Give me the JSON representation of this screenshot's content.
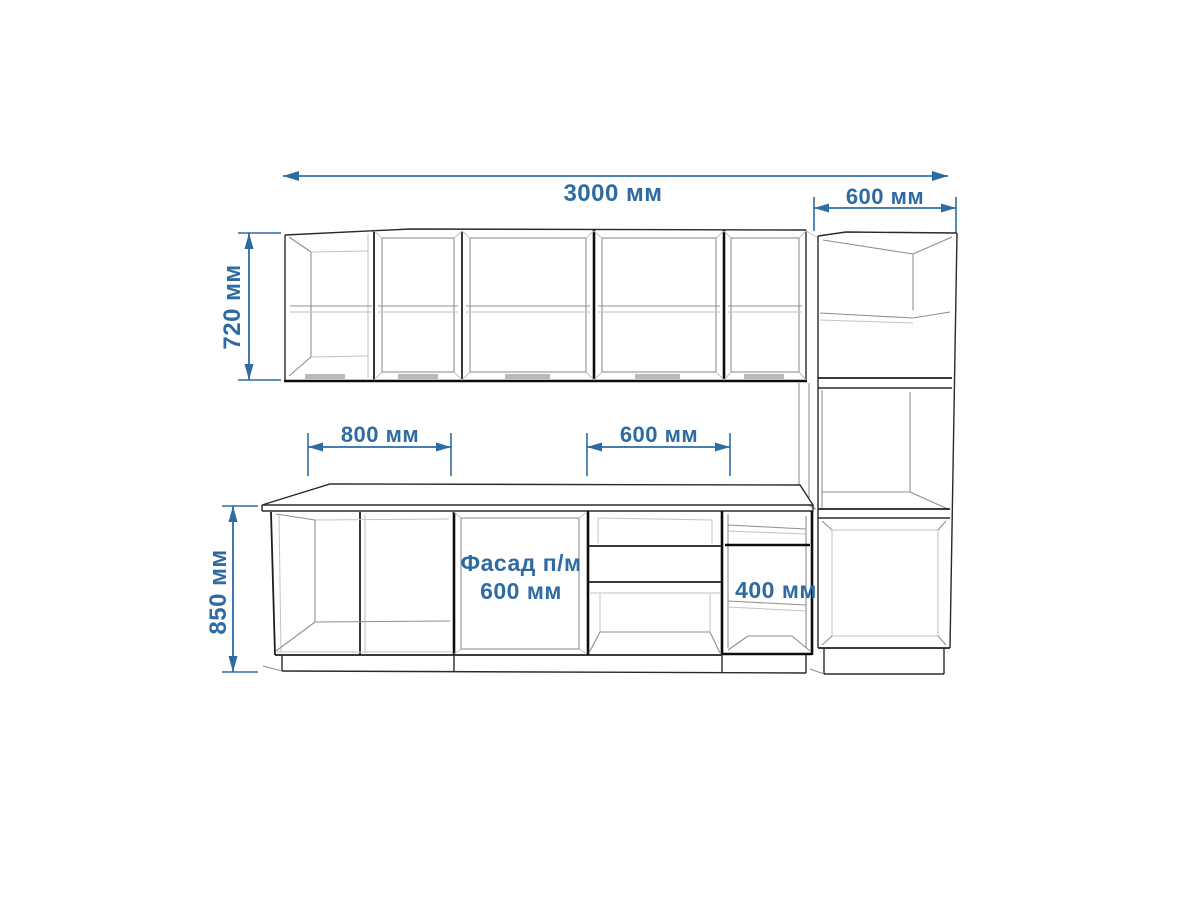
{
  "drawing": {
    "kind": "kitchen-cabinet-elevation",
    "colors": {
      "dimension_blue": "#2e6ba3",
      "outline_dark": "#2a2a2a",
      "outline_heavy": "#0c0c0c",
      "interior_light": "#8f8f8f"
    },
    "labels": {
      "total_width": "3000 мм",
      "tall_unit_width": "600 мм",
      "wall_cabinet_height": "720 мм",
      "base_cabinet_height": "850 мм",
      "base_cabinet_left_width": "800 мм",
      "base_cabinet_mid_width": "600 мм",
      "facade_line1": "Фасад п/м",
      "facade_line2": "600 мм",
      "shelf_cabinet_width": "400 мм"
    }
  }
}
